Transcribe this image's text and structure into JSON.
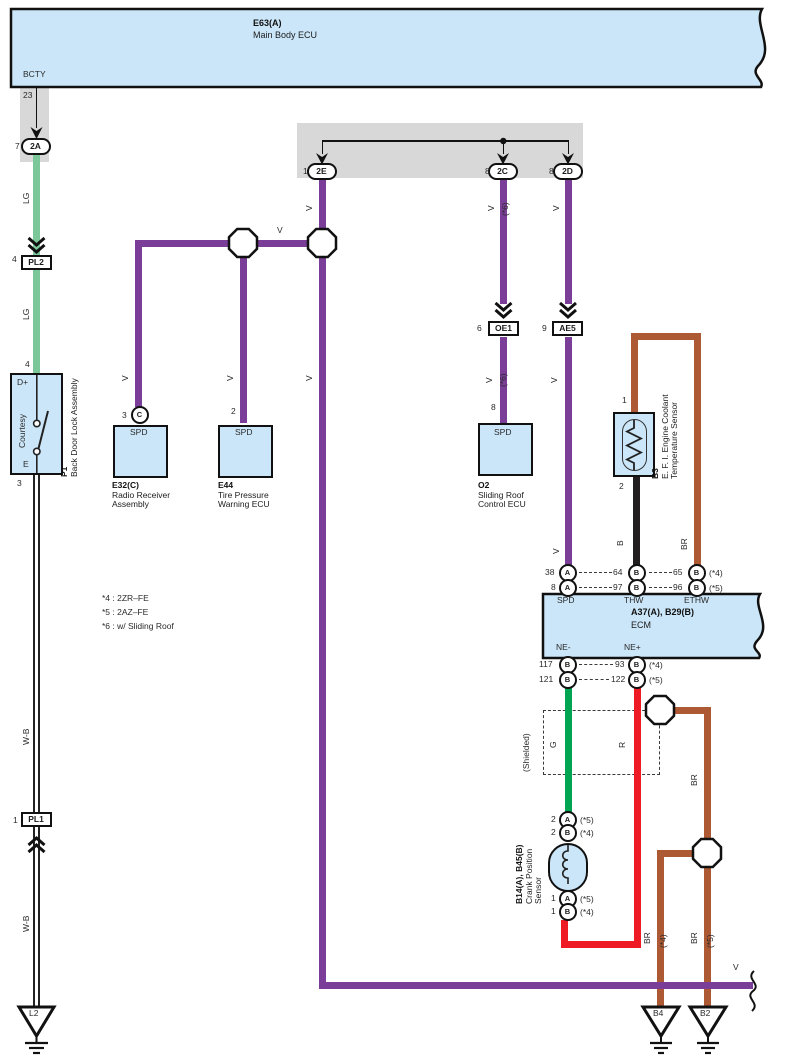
{
  "e63": {
    "id": "E63(A)",
    "name": "Main Body ECU",
    "terminal": "BCTY"
  },
  "ecm": {
    "id": "A37(A), B29(B)",
    "name": "ECM",
    "terminals": {
      "spd": "SPD",
      "thw": "THW",
      "ethw": "ETHW",
      "nem": "NE-",
      "nep": "NE+"
    }
  },
  "comps": {
    "e32": {
      "id": "E32(C)",
      "lines": [
        "Radio Receiver",
        "Assembly"
      ],
      "port": "SPD"
    },
    "e44": {
      "id": "E44",
      "lines": [
        "Tire Pressure",
        "Warning ECU"
      ],
      "port": "SPD"
    },
    "o2": {
      "id": "O2",
      "lines": [
        "Sliding Roof",
        "Control ECU"
      ],
      "port": "SPD"
    },
    "p1": {
      "id": "P1",
      "name": "Back Door Lock Assembly"
    },
    "b3": {
      "id": "B3",
      "lines": [
        "E. F. I. Engine Coolant",
        "Temperature Sensor"
      ]
    },
    "crank": {
      "id": "B14(A), B45(B)",
      "lines": [
        "Crank Position",
        "Sensor"
      ]
    }
  },
  "notes": [
    "*4 : 2ZR–FE",
    "*5 : 2AZ–FE",
    "*6 : w/ Sliding Roof"
  ],
  "colors": {
    "V": "#7b3e98",
    "LG": "#7cc79a",
    "G": "#00a551",
    "R": "#ee1b24",
    "BR": "#ad5a34",
    "B": "#221e1f",
    "WB": "#ffffff",
    "box_fill": "#cbe6f8",
    "gray_strip": "#d8d8d8",
    "line": "#111111"
  },
  "labels": [
    {
      "n": "pin-23",
      "t": "23",
      "x": 23,
      "y": 91
    },
    {
      "n": "pin-7",
      "t": "7",
      "x": 15,
      "y": 142
    },
    {
      "n": "wire-lg-label-1",
      "t": "LG",
      "x": 22,
      "y": 204,
      "r": 1
    },
    {
      "n": "pin-4-pl2",
      "t": "4",
      "x": 12,
      "y": 255
    },
    {
      "n": "wire-lg-label-2",
      "t": "LG",
      "x": 22,
      "y": 320,
      "r": 1
    },
    {
      "n": "pin-4-p1",
      "t": "4",
      "x": 25,
      "y": 360
    },
    {
      "n": "p1-terminal-dplus",
      "t": "D+",
      "x": 17,
      "y": 378
    },
    {
      "n": "p1-switch-label",
      "t": "Courtesy",
      "x": 18,
      "y": 448,
      "r": 1
    },
    {
      "n": "p1-terminal-e",
      "t": "E",
      "x": 23,
      "y": 460
    },
    {
      "n": "pin-3-p1",
      "t": "3",
      "x": 17,
      "y": 479
    },
    {
      "n": "wire-wb-label-1",
      "t": "W-B",
      "x": 22,
      "y": 745,
      "r": 1
    },
    {
      "n": "pin-1-pl1",
      "t": "1",
      "x": 13,
      "y": 816
    },
    {
      "n": "wire-wb-label-2",
      "t": "W-B",
      "x": 22,
      "y": 932,
      "r": 1
    },
    {
      "n": "ground-l2-label",
      "t": "L2",
      "x": 29,
      "y": 1009
    },
    {
      "n": "pin-1-2e",
      "t": "1",
      "x": 303,
      "y": 167
    },
    {
      "n": "pin-8-2c",
      "t": "8",
      "x": 485,
      "y": 167
    },
    {
      "n": "pin-8-2d",
      "t": "8",
      "x": 549,
      "y": 167
    },
    {
      "n": "wire-v-label-2e",
      "t": "V",
      "x": 305,
      "y": 211,
      "r": 1
    },
    {
      "n": "wire-v-label-2c",
      "t": "V",
      "x": 487,
      "y": 211,
      "r": 1
    },
    {
      "n": "wire-s6-label-2c",
      "t": "(*6)",
      "x": 501,
      "y": 216,
      "r": 1
    },
    {
      "n": "wire-v-label-2d",
      "t": "V",
      "x": 552,
      "y": 211,
      "r": 1
    },
    {
      "n": "wire-v-label-horiz",
      "t": "V",
      "x": 277,
      "y": 226
    },
    {
      "n": "wire-v-label-e32",
      "t": "V",
      "x": 121,
      "y": 381,
      "r": 1
    },
    {
      "n": "wire-v-label-e44",
      "t": "V",
      "x": 226,
      "y": 381,
      "r": 1
    },
    {
      "n": "wire-v-label-2e-low",
      "t": "V",
      "x": 305,
      "y": 381,
      "r": 1
    },
    {
      "n": "pin-3-e32",
      "t": "3",
      "x": 122,
      "y": 411
    },
    {
      "n": "pin-2-e44",
      "t": "2",
      "x": 231,
      "y": 407
    },
    {
      "n": "pin-6-oe1",
      "t": "6",
      "x": 477,
      "y": 324
    },
    {
      "n": "wire-v-label-o2",
      "t": "V",
      "x": 485,
      "y": 383,
      "r": 1
    },
    {
      "n": "wire-s6-label-o2",
      "t": "(*6)",
      "x": 499,
      "y": 387,
      "r": 1
    },
    {
      "n": "pin-8-o2",
      "t": "8",
      "x": 491,
      "y": 403
    },
    {
      "n": "pin-9-ae5",
      "t": "9",
      "x": 542,
      "y": 324
    },
    {
      "n": "wire-v-label-ae5",
      "t": "V",
      "x": 550,
      "y": 383,
      "r": 1
    },
    {
      "n": "wire-v-label-spd",
      "t": "V",
      "x": 552,
      "y": 554,
      "r": 1
    },
    {
      "n": "pin-1-b3",
      "t": "1",
      "x": 622,
      "y": 396
    },
    {
      "n": "pin-2-b3",
      "t": "2",
      "x": 619,
      "y": 482
    },
    {
      "n": "wire-b-label",
      "t": "B",
      "x": 616,
      "y": 546,
      "r": 1
    },
    {
      "n": "wire-br-label-b3",
      "t": "BR",
      "x": 680,
      "y": 550,
      "r": 1
    },
    {
      "n": "ecm-pin-38",
      "t": "38",
      "x": 545,
      "y": 568
    },
    {
      "n": "ecm-pin-64",
      "t": "64",
      "x": 613,
      "y": 568
    },
    {
      "n": "ecm-pin-65",
      "t": "65",
      "x": 673,
      "y": 568
    },
    {
      "n": "ecm-pin-65-note",
      "t": "(*4)",
      "x": 709,
      "y": 569
    },
    {
      "n": "ecm-pin-8",
      "t": "8",
      "x": 551,
      "y": 583
    },
    {
      "n": "ecm-pin-97",
      "t": "97",
      "x": 613,
      "y": 583
    },
    {
      "n": "ecm-pin-96",
      "t": "96",
      "x": 673,
      "y": 583
    },
    {
      "n": "ecm-pin-96-note",
      "t": "(*5)",
      "x": 709,
      "y": 584
    },
    {
      "n": "ecm-pin-117",
      "t": "117",
      "x": 539,
      "y": 660
    },
    {
      "n": "ecm-pin-93",
      "t": "93",
      "x": 615,
      "y": 660
    },
    {
      "n": "ecm-pin-93-note",
      "t": "(*4)",
      "x": 649,
      "y": 661
    },
    {
      "n": "ecm-pin-121",
      "t": "121",
      "x": 539,
      "y": 675
    },
    {
      "n": "ecm-pin-122",
      "t": "122",
      "x": 611,
      "y": 675
    },
    {
      "n": "ecm-pin-122-note",
      "t": "(*5)",
      "x": 649,
      "y": 676
    },
    {
      "n": "shield-label",
      "t": "(Shielded)",
      "x": 522,
      "y": 772,
      "r": 1
    },
    {
      "n": "wire-g-label",
      "t": "G",
      "x": 549,
      "y": 748,
      "r": 1
    },
    {
      "n": "wire-r-label",
      "t": "R",
      "x": 618,
      "y": 748,
      "r": 1
    },
    {
      "n": "crank-pin-2a-num",
      "t": "2",
      "x": 551,
      "y": 815
    },
    {
      "n": "crank-pin-2a-note",
      "t": "(*5)",
      "x": 580,
      "y": 816
    },
    {
      "n": "crank-pin-2b-num",
      "t": "2",
      "x": 551,
      "y": 828
    },
    {
      "n": "crank-pin-2b-note",
      "t": "(*4)",
      "x": 580,
      "y": 829
    },
    {
      "n": "crank-pin-1a-num",
      "t": "1",
      "x": 551,
      "y": 894
    },
    {
      "n": "crank-pin-1a-note",
      "t": "(*5)",
      "x": 580,
      "y": 895
    },
    {
      "n": "crank-pin-1b-num",
      "t": "1",
      "x": 551,
      "y": 907
    },
    {
      "n": "crank-pin-1b-note",
      "t": "(*4)",
      "x": 580,
      "y": 908
    },
    {
      "n": "wire-br-label-shield",
      "t": "BR",
      "x": 690,
      "y": 786,
      "r": 1
    },
    {
      "n": "wire-br-label-b4",
      "t": "BR",
      "x": 643,
      "y": 944,
      "r": 1
    },
    {
      "n": "wire-br-note-b4",
      "t": "(*4)",
      "x": 659,
      "y": 948,
      "r": 1
    },
    {
      "n": "wire-br-label-b2",
      "t": "BR",
      "x": 690,
      "y": 944,
      "r": 1
    },
    {
      "n": "wire-br-note-b2",
      "t": "(*5)",
      "x": 706,
      "y": 948,
      "r": 1
    },
    {
      "n": "ground-b4-label",
      "t": "B4",
      "x": 653,
      "y": 1009
    },
    {
      "n": "ground-b2-label",
      "t": "B2",
      "x": 700,
      "y": 1009
    },
    {
      "n": "wire-v-label-bottom",
      "t": "V",
      "x": 733,
      "y": 963
    }
  ],
  "ovals": [
    {
      "n": "connector-2a",
      "t": "2A",
      "x": 36,
      "y": 147
    },
    {
      "n": "connector-2e",
      "t": "2E",
      "x": 322,
      "y": 172
    },
    {
      "n": "connector-2c",
      "t": "2C",
      "x": 503,
      "y": 172
    },
    {
      "n": "connector-2d",
      "t": "2D",
      "x": 568,
      "y": 172
    }
  ],
  "pin_circles": [
    {
      "n": "connector-c-e32",
      "t": "C",
      "x": 140,
      "y": 415
    },
    {
      "n": "ecm-pin-38-circle",
      "t": "A",
      "x": 568,
      "y": 573
    },
    {
      "n": "ecm-pin-64-circle",
      "t": "B",
      "x": 637,
      "y": 573
    },
    {
      "n": "ecm-pin-65-circle",
      "t": "B",
      "x": 697,
      "y": 573
    },
    {
      "n": "ecm-pin-8-circle",
      "t": "A",
      "x": 568,
      "y": 588
    },
    {
      "n": "ecm-pin-97-circle",
      "t": "B",
      "x": 637,
      "y": 588
    },
    {
      "n": "ecm-pin-96-circle",
      "t": "B",
      "x": 697,
      "y": 588
    },
    {
      "n": "ecm-pin-117-circle",
      "t": "B",
      "x": 568,
      "y": 665
    },
    {
      "n": "ecm-pin-93-circle",
      "t": "B",
      "x": 637,
      "y": 665
    },
    {
      "n": "ecm-pin-121-circle",
      "t": "B",
      "x": 568,
      "y": 680
    },
    {
      "n": "ecm-pin-122-circle",
      "t": "B",
      "x": 637,
      "y": 680
    },
    {
      "n": "crank-pin-2a-circle",
      "t": "A",
      "x": 568,
      "y": 820
    },
    {
      "n": "crank-pin-2b-circle",
      "t": "B",
      "x": 568,
      "y": 833
    },
    {
      "n": "crank-pin-1a-circle",
      "t": "A",
      "x": 568,
      "y": 899
    },
    {
      "n": "crank-pin-1b-circle",
      "t": "B",
      "x": 568,
      "y": 912
    }
  ],
  "rect_connectors": [
    {
      "n": "connector-pl2",
      "t": "PL2",
      "x": 36.5,
      "y": 263
    },
    {
      "n": "connector-pl1",
      "t": "PL1",
      "x": 36.5,
      "y": 820
    },
    {
      "n": "connector-oe1",
      "t": "OE1",
      "x": 504,
      "y": 329
    },
    {
      "n": "connector-ae5",
      "t": "AE5",
      "x": 568,
      "y": 329
    }
  ],
  "wires": [
    {
      "n": "wire-lg-1",
      "x": 33,
      "y": 155,
      "w": 7,
      "h": 101,
      "c": "LG"
    },
    {
      "n": "wire-lg-2",
      "x": 33,
      "y": 270,
      "w": 7,
      "h": 103,
      "c": "LG"
    },
    {
      "n": "wire-wb-1",
      "x": 33,
      "y": 475,
      "w": 7,
      "h": 338,
      "c": "WB"
    },
    {
      "n": "wire-wb-2",
      "x": 33,
      "y": 827,
      "w": 7,
      "h": 180,
      "c": "WB"
    },
    {
      "n": "wire-v-2e",
      "x": 318.5,
      "y": 179,
      "w": 7,
      "h": 810,
      "c": "V"
    },
    {
      "n": "wire-v-j2-j1",
      "x": 243,
      "y": 239.5,
      "w": 79,
      "h": 7,
      "c": "V"
    },
    {
      "n": "wire-v-left",
      "x": 134.5,
      "y": 239.5,
      "w": 112,
      "h": 7,
      "c": "V"
    },
    {
      "n": "wire-v-e32",
      "x": 134.5,
      "y": 243,
      "w": 7,
      "h": 164,
      "c": "V"
    },
    {
      "n": "wire-v-e44",
      "x": 239.5,
      "y": 243,
      "w": 7,
      "h": 180,
      "c": "V"
    },
    {
      "n": "wire-v-2c-upper",
      "x": 499.5,
      "y": 179,
      "w": 7,
      "h": 125,
      "c": "V"
    },
    {
      "n": "wire-v-2c-lower",
      "x": 499.5,
      "y": 337,
      "w": 7,
      "h": 86,
      "c": "V"
    },
    {
      "n": "wire-v-2d-upper",
      "x": 564.5,
      "y": 179,
      "w": 7,
      "h": 125,
      "c": "V"
    },
    {
      "n": "wire-v-2d-lower",
      "x": 564.5,
      "y": 337,
      "w": 7,
      "h": 228,
      "c": "V"
    },
    {
      "n": "wire-b-b3",
      "x": 632.5,
      "y": 477,
      "w": 7,
      "h": 88,
      "c": "B"
    },
    {
      "n": "wire-br-b3-up",
      "x": 630.5,
      "y": 333,
      "w": 7,
      "h": 79,
      "c": "BR"
    },
    {
      "n": "wire-br-b3-top",
      "x": 630.5,
      "y": 333,
      "w": 70,
      "h": 7,
      "c": "BR"
    },
    {
      "n": "wire-br-b3-down",
      "x": 693.5,
      "y": 333,
      "w": 7,
      "h": 232,
      "c": "BR"
    },
    {
      "n": "wire-br-shield-h",
      "x": 670,
      "y": 706.5,
      "w": 40.5,
      "h": 7,
      "c": "BR"
    },
    {
      "n": "wire-br-shield-v",
      "x": 703.5,
      "y": 706.5,
      "w": 7,
      "h": 147,
      "c": "BR"
    },
    {
      "n": "wire-br-j4-left",
      "x": 656.5,
      "y": 849.5,
      "w": 45,
      "h": 7,
      "c": "BR"
    },
    {
      "n": "wire-br-b4",
      "x": 656.5,
      "y": 850,
      "w": 7,
      "h": 157,
      "c": "BR"
    },
    {
      "n": "wire-br-b2",
      "x": 703.5,
      "y": 860,
      "w": 7,
      "h": 147,
      "c": "BR"
    },
    {
      "n": "wire-g",
      "x": 564.5,
      "y": 688,
      "w": 7,
      "h": 124,
      "c": "G"
    },
    {
      "n": "wire-r-down",
      "x": 633.5,
      "y": 688,
      "w": 7,
      "h": 260,
      "c": "R"
    },
    {
      "n": "wire-r-bottom",
      "x": 561,
      "y": 941,
      "w": 80,
      "h": 7,
      "c": "R"
    },
    {
      "n": "wire-r-up",
      "x": 561,
      "y": 920,
      "w": 7,
      "h": 28,
      "c": "R"
    },
    {
      "n": "wire-v-bottom",
      "x": 318.5,
      "y": 982,
      "w": 434,
      "h": 7,
      "c": "V"
    }
  ],
  "dashes": [
    {
      "x": 579,
      "y": 572,
      "w": 33
    },
    {
      "x": 649,
      "y": 572,
      "w": 23
    },
    {
      "x": 579,
      "y": 587,
      "w": 33
    },
    {
      "x": 649,
      "y": 587,
      "w": 23
    },
    {
      "x": 579,
      "y": 664,
      "w": 34
    },
    {
      "x": 579,
      "y": 679,
      "w": 30
    }
  ],
  "thin_lines": [
    {
      "x": 35.8,
      "y": 88,
      "w": 1.5,
      "h": 40
    },
    {
      "x": 321.5,
      "y": 140,
      "w": 247,
      "h": 1.5
    },
    {
      "x": 321.5,
      "y": 140,
      "w": 1.5,
      "h": 14
    },
    {
      "x": 502.5,
      "y": 140,
      "w": 1.5,
      "h": 14
    },
    {
      "x": 567.5,
      "y": 140,
      "w": 1.5,
      "h": 14
    }
  ]
}
